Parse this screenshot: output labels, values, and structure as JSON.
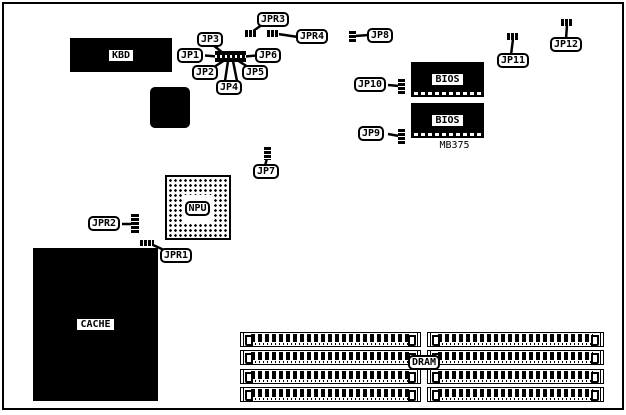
{
  "board": {
    "chips": {
      "kbd": "KBD",
      "npu": "NPU",
      "cache": "CACHE",
      "bios_top": "BIOS",
      "bios_bottom": "BIOS",
      "chipset": "MB375"
    },
    "dram": {
      "label": "DRAM",
      "banks": 2,
      "sockets_per_bank": 4
    },
    "jumpers": {
      "jp1": "JP1",
      "jp2": "JP2",
      "jp3": "JP3",
      "jp4": "JP4",
      "jp5": "JP5",
      "jp6": "JP6",
      "jp7": "JP7",
      "jp8": "JP8",
      "jp9": "JP9",
      "jp10": "JP10",
      "jp11": "JP11",
      "jp12": "JP12",
      "jpr1": "JPR1",
      "jpr2": "JPR2",
      "jpr3": "JPR3",
      "jpr4": "JPR4"
    },
    "colors": {
      "ink": "#000000",
      "paper": "#ffffff"
    }
  }
}
